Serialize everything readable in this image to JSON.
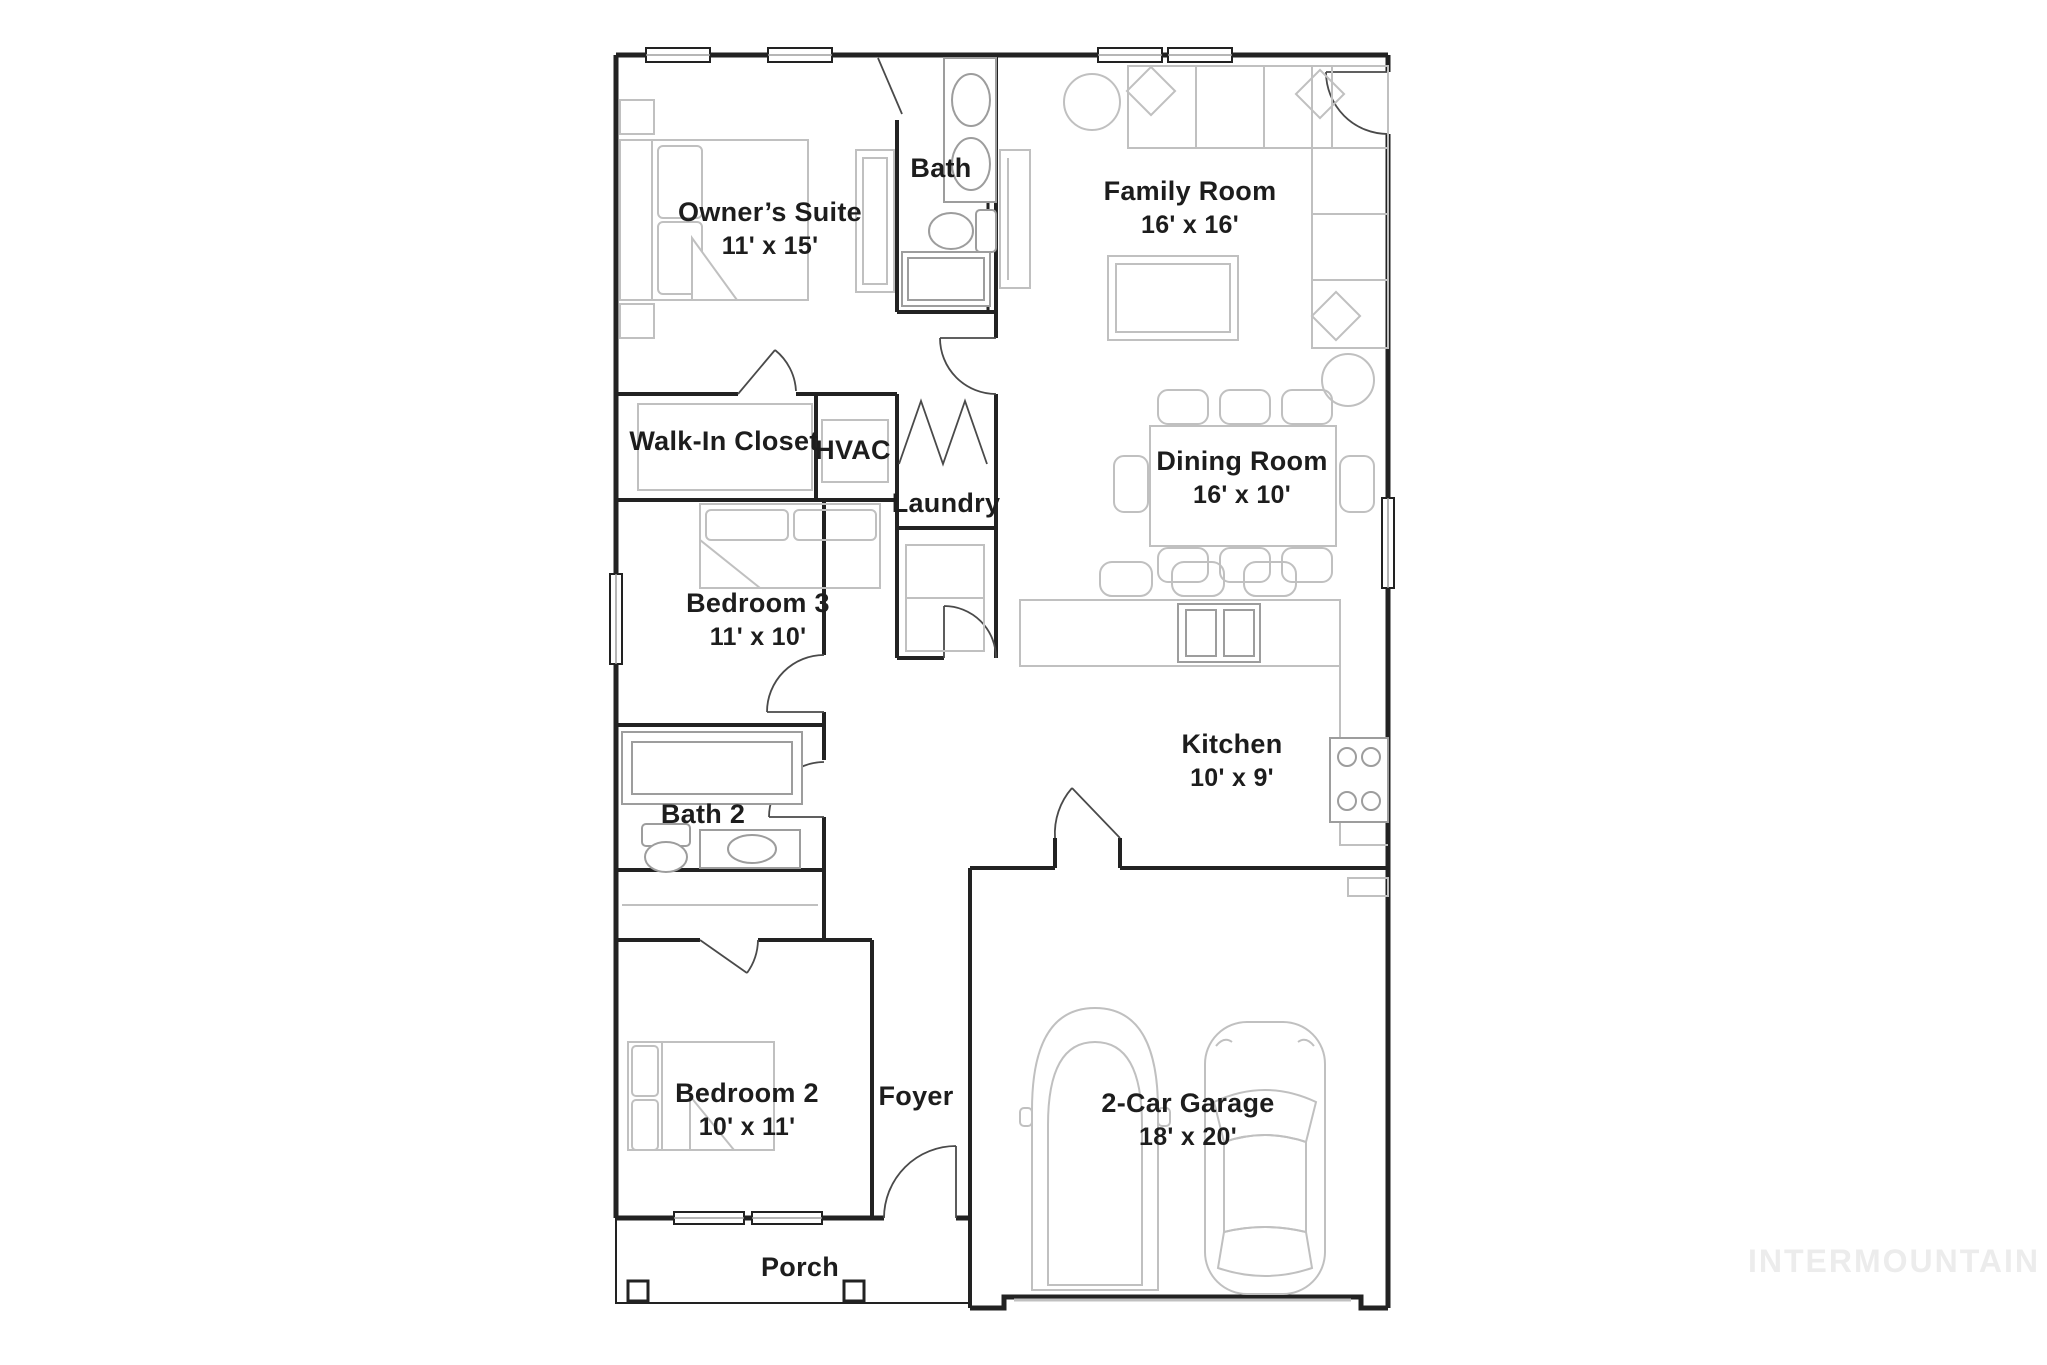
{
  "plan": {
    "watermark": "INTERMOUNTAIN",
    "colors": {
      "wall": "#222222",
      "door": "#4a4a4a",
      "furniture": "#c0c0c0",
      "fixture": "#9d9d9d",
      "text": "#1d1d1d",
      "watermark": "#ececec"
    },
    "rooms": {
      "owners_suite": {
        "name": "Owner’s Suite",
        "dims": "11' x 15'"
      },
      "bath": {
        "name": "Bath"
      },
      "family_room": {
        "name": "Family Room",
        "dims": "16' x 16'"
      },
      "walk_in_closet": {
        "name": "Walk-In Closet"
      },
      "hvac": {
        "name": "HVAC"
      },
      "laundry": {
        "name": "Laundry"
      },
      "dining_room": {
        "name": "Dining Room",
        "dims": "16' x 10'"
      },
      "bedroom3": {
        "name": "Bedroom 3",
        "dims": "11' x 10'"
      },
      "kitchen": {
        "name": "Kitchen",
        "dims": "10' x 9'"
      },
      "bath2": {
        "name": "Bath 2"
      },
      "bedroom2": {
        "name": "Bedroom 2",
        "dims": "10' x 11'"
      },
      "foyer": {
        "name": "Foyer"
      },
      "garage": {
        "name": "2-Car Garage",
        "dims": "18' x 20'"
      },
      "porch": {
        "name": "Porch"
      }
    }
  }
}
